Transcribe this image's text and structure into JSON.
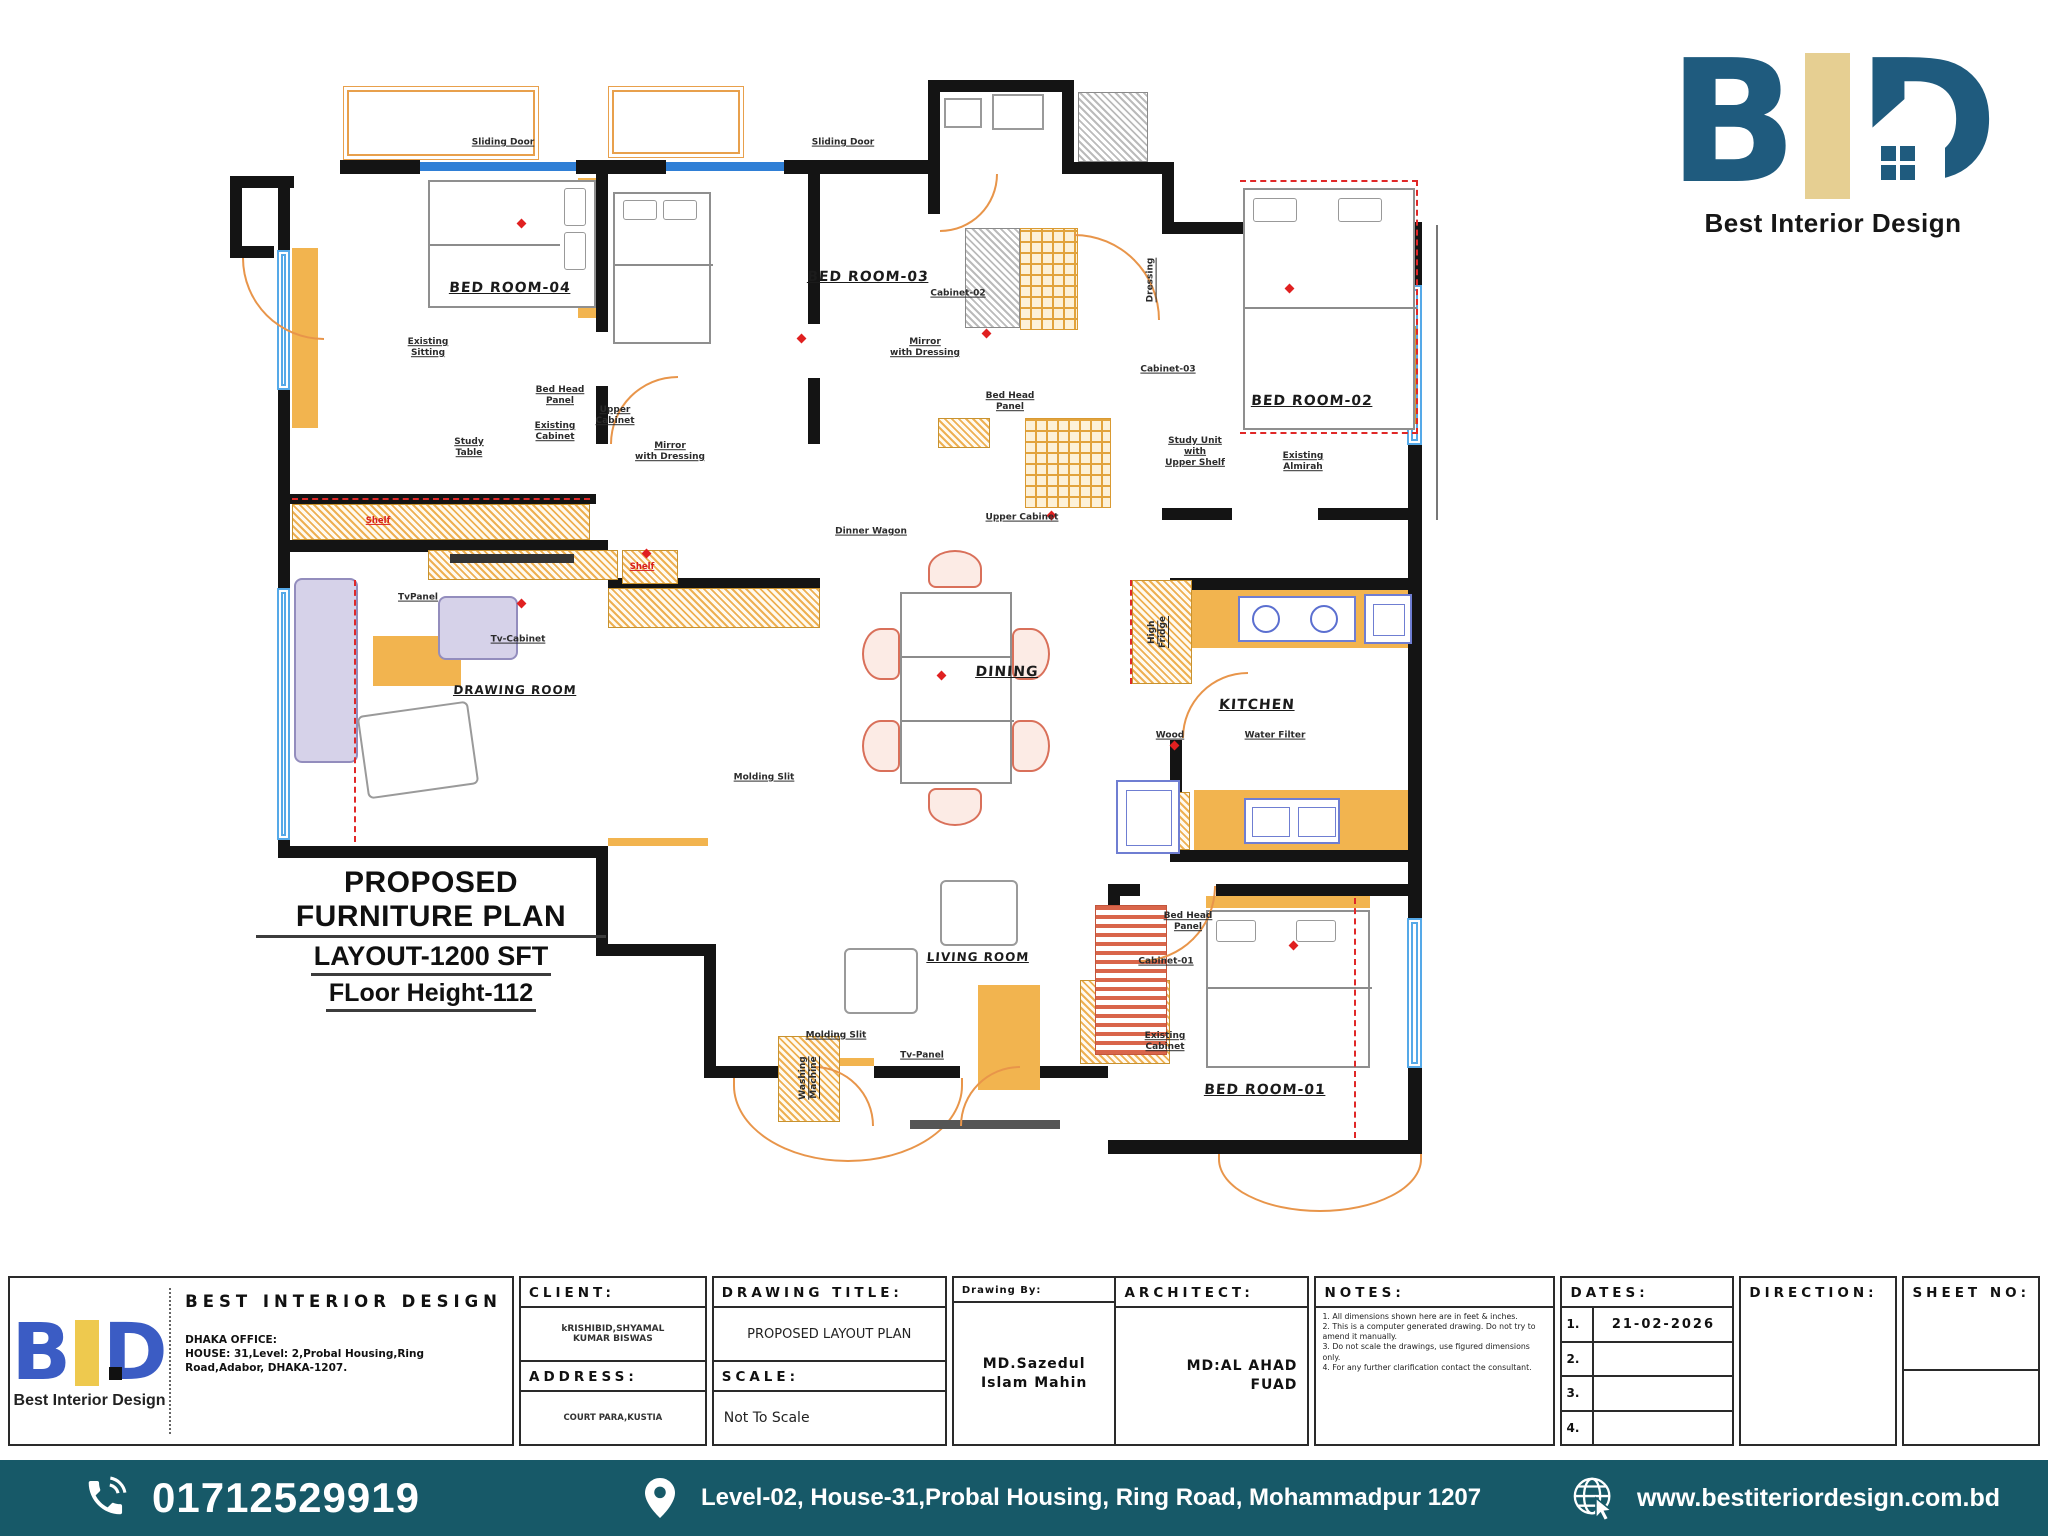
{
  "colors": {
    "footer_bg": "#175968",
    "logo_blue_dark": "#1f5b7e",
    "logo_tan": "#e6cf92",
    "logo_blue_small": "#3b5cc4",
    "logo_yellow_small": "#eec94e",
    "plan_accent_orange": "#f2b44f",
    "window_blue": "#55a9e8",
    "marker_red": "#e02020"
  },
  "logo_top": {
    "brand": "Best Interior Design"
  },
  "plan": {
    "title_lines": [
      "PROPOSED FURNITURE PLAN",
      "LAYOUT-1200 SFT",
      "FLoor Height-112"
    ],
    "room_labels": [
      {
        "text": "BED ROOM-04",
        "style": "left:232px;top:208px"
      },
      {
        "text": "BED ROOM-03",
        "style": "left:590px;top:197px"
      },
      {
        "text": "BED ROOM-02",
        "style": "left:1034px;top:321px"
      },
      {
        "text": "DRAWING ROOM",
        "style": "left:237px;top:610px;font-size:12px"
      },
      {
        "text": "DINING",
        "style": "left:729px;top:592px"
      },
      {
        "text": "KITCHEN",
        "style": "left:979px;top:625px"
      },
      {
        "text": "LIVING ROOM",
        "style": "left:700px;top:877px;font-size:12px"
      },
      {
        "text": "BED ROOM-01",
        "style": "left:987px;top:1010px"
      }
    ],
    "furniture_labels": [
      {
        "text": "Sliding Door",
        "style": "left:225px;top:63px"
      },
      {
        "text": "Sliding Door",
        "style": "left:565px;top:63px"
      },
      {
        "text": "Existing\nSitting",
        "style": "left:150px;top:268px"
      },
      {
        "text": "Study\nTable",
        "style": "left:191px;top:368px"
      },
      {
        "text": "Existing\nCabinet",
        "style": "left:277px;top:352px"
      },
      {
        "text": "Upper\nCabinet",
        "style": "left:337px;top:336px"
      },
      {
        "text": "Mirror\nwith Dressing",
        "style": "left:392px;top:372px"
      },
      {
        "text": "Shelf",
        "cls": "red",
        "style": "left:100px;top:441px"
      },
      {
        "text": "Shelf",
        "cls": "red",
        "style": "left:364px;top:487px"
      },
      {
        "text": "TvPanel",
        "style": "left:140px;top:518px"
      },
      {
        "text": "Tv-Cabinet",
        "style": "left:240px;top:560px"
      },
      {
        "text": "Bed Head\nPanel",
        "style": "left:282px;top:316px"
      },
      {
        "text": "Cabinet-02",
        "style": "left:680px;top:214px"
      },
      {
        "text": "Mirror\nwith Dressing",
        "style": "left:647px;top:268px"
      },
      {
        "text": "Bed Head\nPanel",
        "style": "left:732px;top:322px"
      },
      {
        "text": "Dinner Wagon",
        "style": "left:593px;top:452px"
      },
      {
        "text": "Upper Cabinet",
        "style": "left:744px;top:438px"
      },
      {
        "text": "Dressing",
        "cls": "vert",
        "style": "left:873px;top:200px"
      },
      {
        "text": "Cabinet-03",
        "style": "left:890px;top:290px"
      },
      {
        "text": "Study Unit\nwith\nUpper Shelf",
        "style": "left:917px;top:372px"
      },
      {
        "text": "Existing\nAlmirah",
        "style": "left:1025px;top:382px"
      },
      {
        "text": "High\nFridge",
        "cls": "vert",
        "style": "left:880px;top:552px"
      },
      {
        "text": "Wood",
        "style": "left:892px;top:656px"
      },
      {
        "text": "Water Filter",
        "style": "left:997px;top:656px"
      },
      {
        "text": "Molding Slit",
        "style": "left:486px;top:698px"
      },
      {
        "text": "Molding Slit",
        "style": "left:558px;top:956px"
      },
      {
        "text": "Tv-Panel",
        "style": "left:644px;top:976px"
      },
      {
        "text": "Washing\nMachine",
        "cls": "vert",
        "style": "left:531px;top:998px"
      },
      {
        "text": "Bed Head\nPanel",
        "style": "left:910px;top:842px"
      },
      {
        "text": "Cabinet-01",
        "style": "left:888px;top:882px"
      },
      {
        "text": "Existing\nCabinet",
        "style": "left:887px;top:962px"
      }
    ]
  },
  "title_block": {
    "company": "BEST INTERIOR DESIGN",
    "brand_small": "Best Interior Design",
    "office": "DHAKA OFFICE:\nHOUSE: 31,Level: 2,Probal Housing,Ring\nRoad,Adabor, DHAKA-1207.",
    "client_header": "CLIENT:",
    "client_value": "kRISHIBID,SHYAMAL\nKUMAR BISWAS",
    "address_header": "ADDRESS:",
    "address_value": "COURT PARA,KUSTIA",
    "drawing_title_header": "DRAWING TITLE:",
    "drawing_title_value": "PROPOSED LAYOUT PLAN",
    "scale_header": "SCALE:",
    "scale_value": "Not To Scale",
    "drawing_by_header": "Drawing By:",
    "drawing_by_value": "MD.Sazedul\nIslam Mahin",
    "architect_header": "ARCHITECT:",
    "architect_value": "MD:AL AHAD\nFUAD",
    "notes_header": "NOTES:",
    "notes": [
      "1. All dimensions shown here are in feet & inches.",
      "2. This is a computer generated drawing. Do not try to amend it manually.",
      "3. Do not scale the drawings, use figured dimensions only.",
      "4. For any further clarification contact the consultant."
    ],
    "dates_header": "DATES:",
    "dates": [
      {
        "no": "1.",
        "value": "21-02-2026"
      },
      {
        "no": "2.",
        "value": ""
      },
      {
        "no": "3.",
        "value": ""
      },
      {
        "no": "4.",
        "value": ""
      }
    ],
    "direction_header": "DIRECTION:",
    "sheet_header": "SHEET NO:"
  },
  "footer": {
    "phone": "01712529919",
    "address": "Level-02, House-31,Probal Housing, Ring Road, Mohammadpur 1207",
    "website": "www.bestiteriordesign.com.bd"
  }
}
